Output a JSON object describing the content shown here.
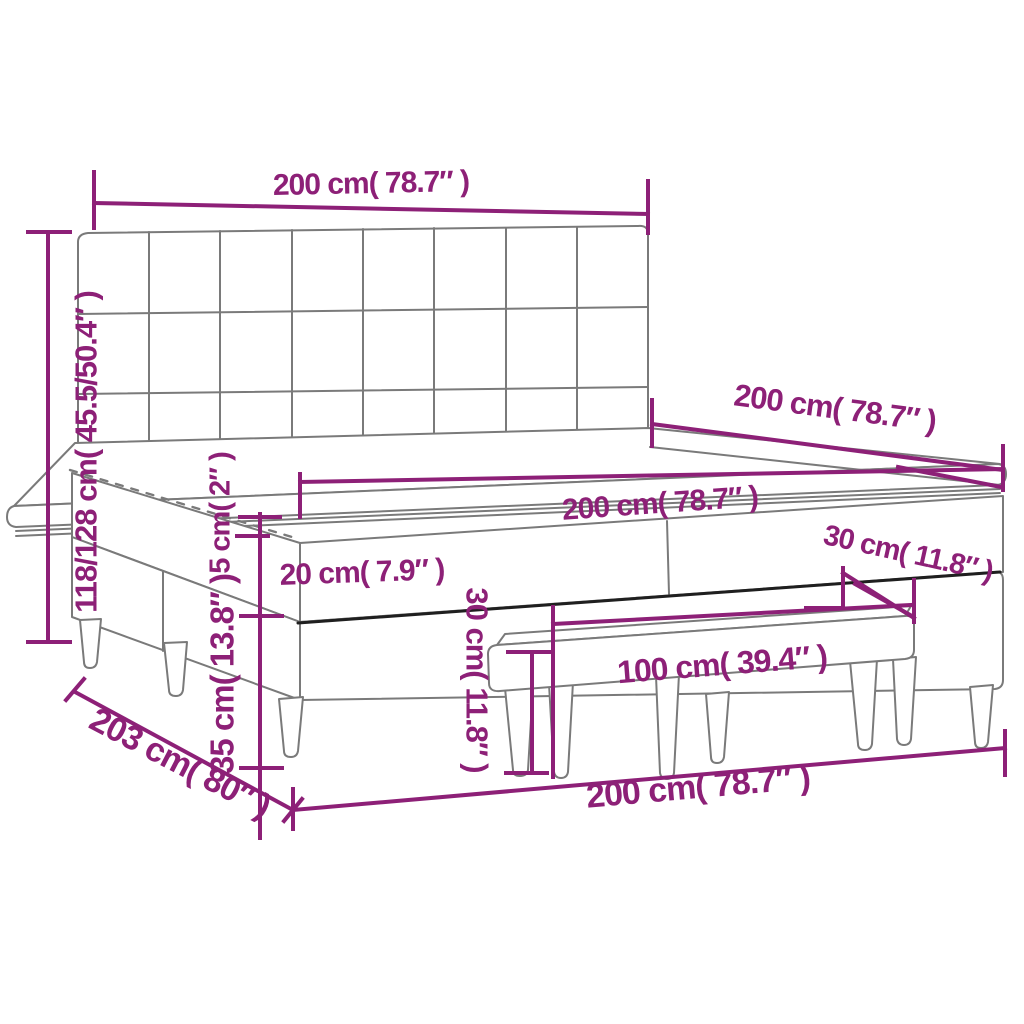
{
  "figure": {
    "type": "product dimension diagram",
    "subject": "box spring bed with headboard, topper and bench"
  },
  "colors": {
    "dimension_accent": "#8d2077",
    "line_art_gray": "#7a7a7a",
    "edge_dark": "#1f1f1f",
    "background": "#ffffff"
  },
  "dimensions": {
    "headboard_width": {
      "label": "200 cm( 78.7″ )"
    },
    "bed_height": {
      "label": "118/128 cm( 45.5/50.4″ )"
    },
    "bed_depth_top": {
      "label": "200 cm( 78.7″ )"
    },
    "mattress_width": {
      "label": "200 cm( 78.7″ )"
    },
    "topper_height": {
      "label": "5 cm( 2″ )"
    },
    "mattress_height": {
      "label": "20 cm( 7.9″ )"
    },
    "bench_depth": {
      "label": "30 cm( 11.8″ )"
    },
    "bench_height": {
      "label": "30 cm( 11.8″ )"
    },
    "bench_width": {
      "label": "100 cm( 39.4″ )"
    },
    "base_leg_height": {
      "label": "35 cm( 13.8″ )"
    },
    "bed_length": {
      "label": "203 cm( 80″ )"
    },
    "bed_width_bottom": {
      "label": "200 cm( 78.7″ )"
    }
  }
}
